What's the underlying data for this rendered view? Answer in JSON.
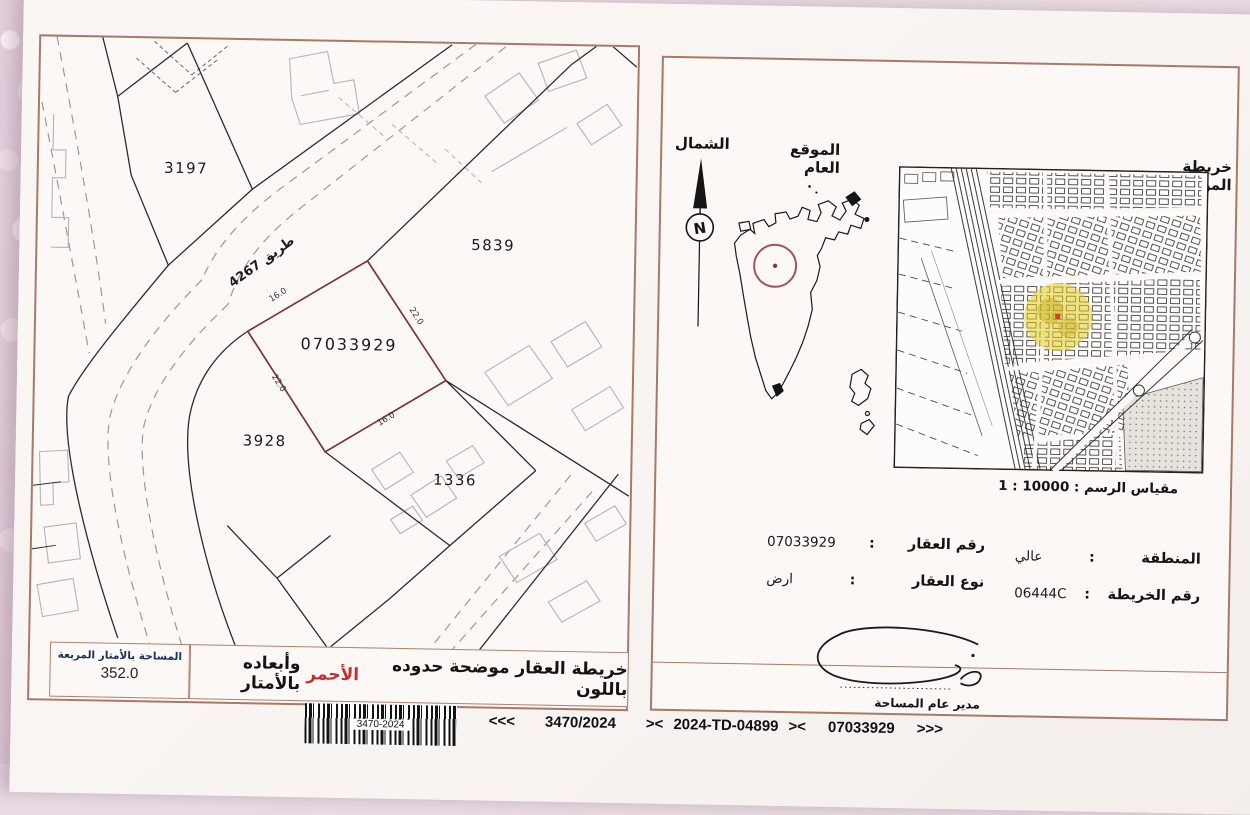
{
  "document_title": "خريطة عقار - جهاز المساحة والتسجيل العقاري",
  "left_panel": {
    "plots": {
      "p3197": "3197",
      "p5839": "5839",
      "subject": "07033929",
      "p3928": "3928",
      "p1336": "1336"
    },
    "road_label": "طريق 4267",
    "dimensions": {
      "top_left": "16.0",
      "top_right": "22.0",
      "bottom_left": "22.0",
      "bottom_right": "16.0"
    },
    "area_box": {
      "label": "المساحة بالأمتار المربعة",
      "value": "352.0"
    },
    "caption": {
      "prefix": "خريطة العقار موضحة حدوده باللون",
      "red_word": "الأحمر",
      "suffix": "وأبعاده بالأمتار"
    }
  },
  "right_panel": {
    "north_label": "الشمال",
    "north_letter": "N",
    "general_location_title": "الموقع العام",
    "location_map_title": "خريطة الموقع",
    "scale_text": "1 : 10000 : مقياس الرسم",
    "fields": {
      "property_number_label": "رقم العقار",
      "property_number_value": "07033929",
      "property_type_label": "نوع العقار",
      "property_type_value": "ارض",
      "district_label": "المنطقة",
      "district_value": "عالي",
      "map_number_label": "رقم الخريطة",
      "map_number_value": "06444C",
      "colon": ":"
    },
    "signature_title": "مدير عام المساحة"
  },
  "footer": {
    "barcode_label": "3470-2024",
    "left_arrows": "<<<",
    "ref1": "3470/2024",
    "sep1": "><",
    "ref2": "2024-TD-04899",
    "sep2": "><",
    "ref3": "07033929",
    "right_arrows": ">>>"
  },
  "colors": {
    "panel_border": "#a8796a",
    "subject_boundary": "#7d3040",
    "red_text": "#c03030",
    "highlight_yellow": "#e2cd22",
    "location_circle": "#a05555"
  }
}
